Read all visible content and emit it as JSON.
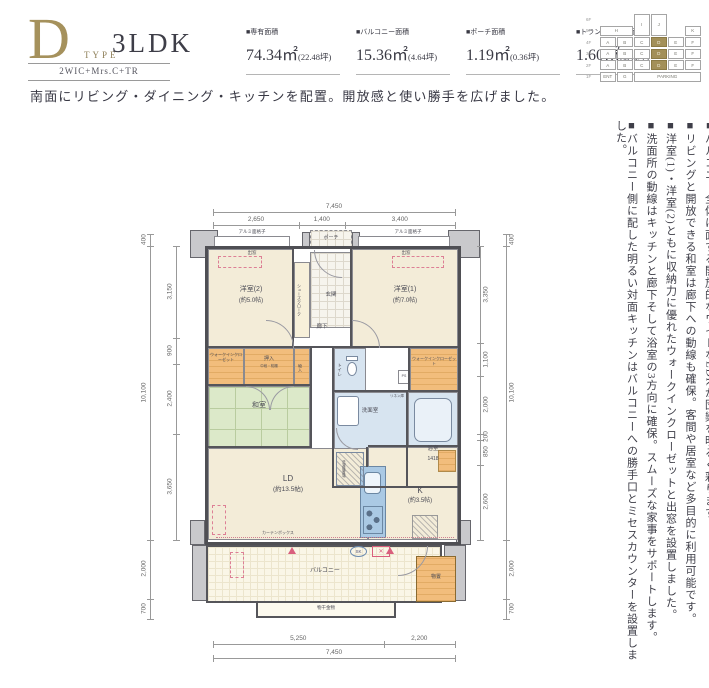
{
  "header": {
    "type_letter": "D",
    "type_word": "TYPE",
    "plan_name": "3LDK",
    "subtitle": "2WIC+Mrs.C+TR",
    "specs": [
      {
        "label": "■専有面積",
        "value": "74.34㎡",
        "note": "(22.48坪)"
      },
      {
        "label": "■バルコニー面積",
        "value": "15.36㎡",
        "note": "(4.64坪)"
      },
      {
        "label": "■ポーチ面積",
        "value": "1.19㎡",
        "note": "(0.36坪)"
      },
      {
        "label": "■トランクルーム面積",
        "value": "1.60㎡",
        "note": "(0.48坪)"
      }
    ]
  },
  "keyplan": {
    "floors": [
      "6F",
      "5F",
      "4F",
      "3F",
      "2F",
      "1F"
    ],
    "top_cells": [
      "I",
      "J"
    ],
    "side_cells": [
      "H",
      "K"
    ],
    "letters": [
      "A",
      "B",
      "C",
      "D",
      "E",
      "F"
    ],
    "highlight": "D",
    "bottom_cells": [
      "ENT",
      "G",
      "PARKING"
    ],
    "highlight_color": "#a39059"
  },
  "headline": "南面にリビング・ダイニング・キッチンを配置。開放感と使い勝手を広げました。",
  "features": [
    "■バルコニー全体に面する開放的なワイドなLDKが団欒を明るく彩ります。",
    "■リビングと開放できる和室は廊下への動線も確保。客間や居室など多目的に利用可能です。",
    "■洋室(1)・洋室(2)ともに収納力に優れたウォークインクローゼットと出窓を設置しました。",
    "■洗面所の動線はキッチンと廊下そして浴室の3方向に確保。スムーズな家事をサポートします。",
    "■バルコニー側に配した明るい対面キッチンはバルコニーへの勝手口とミセスカウンターを設置しました。"
  ],
  "plan": {
    "labels": {
      "western2": "洋室(2)",
      "western2_size": "(約5.0帖)",
      "western1": "洋室(1)",
      "western1_size": "(約7.0帖)",
      "washitsu": "和室",
      "ld": "LD",
      "ld_size": "(約13.5帖)",
      "k": "K",
      "k_size": "(約3.5帖)",
      "balcony": "バルコニー",
      "porch": "ポーチ",
      "entry": "玄関",
      "hall": "廊下",
      "shoes_closet": "シューズクローク",
      "wic": "ウォークインクローゼット",
      "oshiire": "押入",
      "oshiire_sub": "中段・枕棚",
      "storage_small": "物入",
      "toilet": "トイレ",
      "washroom": "洗面室",
      "bath": "浴室",
      "bath_size": "1418",
      "laundry": "洗濯機置場",
      "linen": "リネン庫",
      "ps": "PS",
      "trunk": "物置",
      "sk": "SK",
      "hatch_mark": "✕",
      "bay_window": "出窓",
      "grille": "アルミ面格子",
      "curtain_box": "カーテンボックス",
      "laundry_pole": "物干金物"
    },
    "dimensions": {
      "top_total": [
        "7,450"
      ],
      "top_segments": [
        "2,650",
        "1,400",
        "3,400"
      ],
      "bottom_segments": [
        "5,250",
        "2,200"
      ],
      "bottom_total": [
        "7,450"
      ],
      "left_outer": [
        "400",
        "10,100",
        "2,000",
        "700"
      ],
      "left_inner": [
        "3,150",
        "900",
        "2,400",
        "3,650"
      ],
      "right_inner": [
        "3,350",
        "1,100",
        "2,000",
        "200",
        "850",
        "2,600"
      ],
      "right_outer": [
        "400",
        "10,100",
        "2,000",
        "700"
      ]
    }
  }
}
